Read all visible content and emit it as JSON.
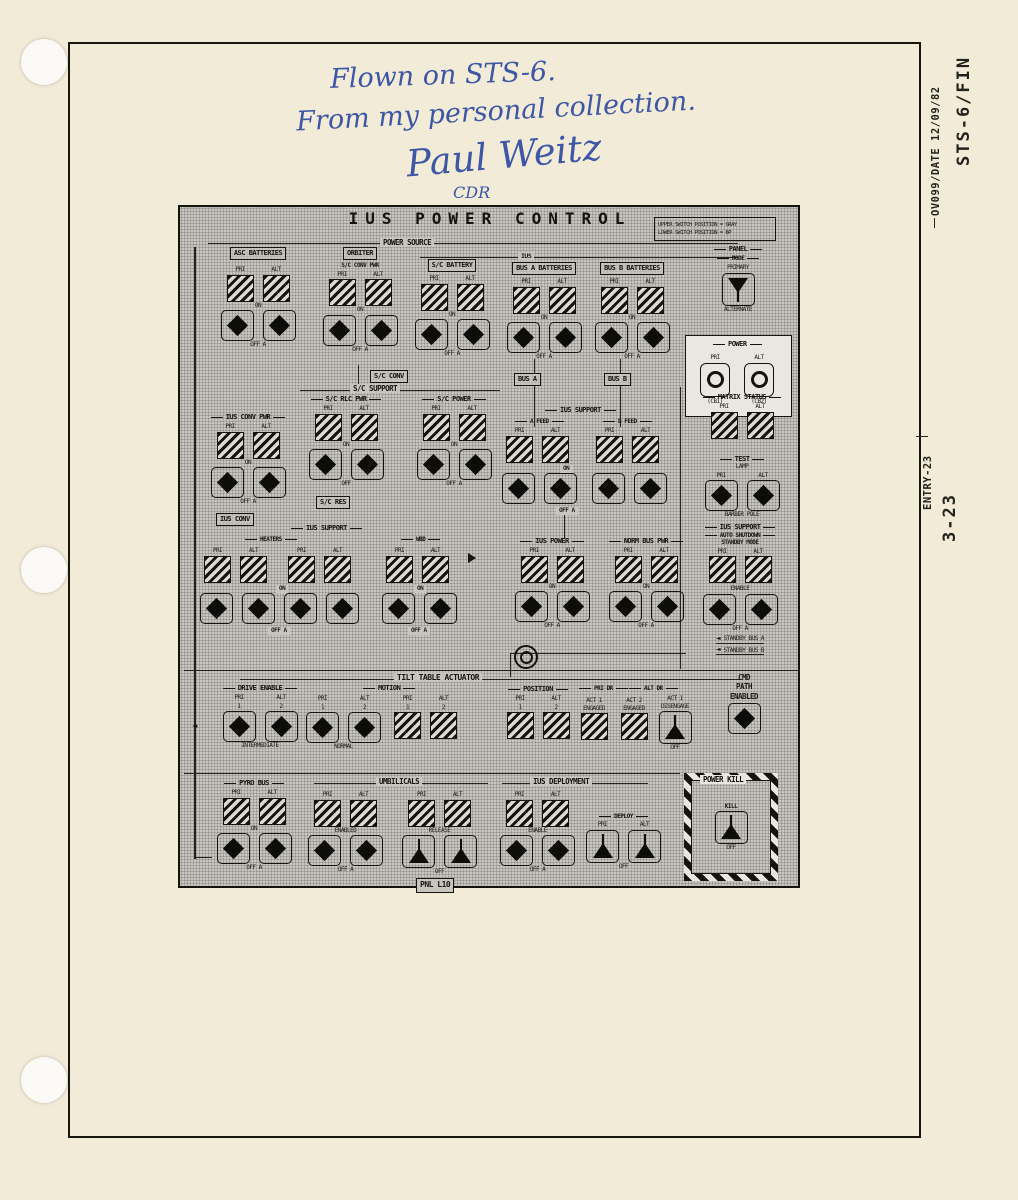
{
  "margin": {
    "doc_ref": "OV099/DATE 12/09/82",
    "mission": "STS-6/FIN",
    "entry": "ENTRY-23",
    "page_num": "3-23"
  },
  "handwriting": {
    "line1": "Flown on STS-6.",
    "line2": "From my personal collection.",
    "signature": "Paul Weitz",
    "role": "CDR",
    "ink_color": "#3d56a5"
  },
  "diagram": {
    "title": "IUS POWER CONTROL",
    "note1": "UPPER SWITCH POSITION = GRAY",
    "note2": "LOWER SWITCH POSITION = BP",
    "footer": "PNL L10",
    "halftone_base": "#c8c5bf"
  },
  "sec": {
    "power_source": "POWER SOURCE",
    "asc_batteries": "ASC BATTERIES",
    "orbiter": "ORBITER",
    "sc_conv_pwr": "S/C CONV PWR",
    "sc_conv": "S/C CONV",
    "ius": "IUS",
    "sc_battery": "S/C BATTERY",
    "bus_a_batteries": "BUS A BATTERIES",
    "bus_b_batteries": "BUS B BATTERIES",
    "bus_a": "BUS A",
    "bus_b": "BUS B",
    "panel": "PANEL",
    "mode": "MODE",
    "primary": "PRIMARY",
    "alternate": "ALTERNATE",
    "power": "POWER",
    "cb1": "(CB1)",
    "cb2": "(CB2)",
    "matrix_status": "MATRIX STATUS",
    "test": "TEST",
    "lamp": "LAMP",
    "barber_pole": "BARBER POLE",
    "ius_support": "IUS SUPPORT",
    "auto_shutdown": "AUTO SHUTDOWN",
    "standby_mode": "STANDBY MODE",
    "enable": "ENABLE",
    "standby_bus_a": "STANDBY BUS A",
    "standby_bus_b": "STANDBY BUS B",
    "ius_conv_pwr": "IUS CONV PWR",
    "ius_conv": "IUS CONV",
    "sc_support": "S/C SUPPORT",
    "sc_rlc_pwr": "S/C RLC PWR",
    "sc_res": "S/C RES",
    "sc_power": "S/C POWER",
    "a_feed": "A FEED",
    "b_feed": "B FEED",
    "heaters": "HEATERS",
    "wbd": "WBD",
    "ius_power": "IUS POWER",
    "norm_bus_pwr": "NORM BUS PWR",
    "tilt_table": "TILT TABLE ACTUATOR",
    "drive_enable": "DRIVE ENABLE",
    "motion": "MOTION",
    "intermediate": "INTERMEDIATE",
    "normal": "NORMAL",
    "position": "POSITION",
    "pri_dr": "PRI DR",
    "alt_dr": "ALT DR",
    "act1_engaged": "ACT 1 ENGAGED",
    "act2_engaged": "ACT 2 ENGAGED",
    "act1_disengage": "ACT 1 DISENGAGE",
    "cmd": "CMD",
    "path": "PATH",
    "enabled": "ENABLED",
    "pyro_bus": "PYRO BUS",
    "umbilicals": "UMBILICALS",
    "release": "RELEASE",
    "ius_deployment": "IUS DEPLOYMENT",
    "deploy": "DEPLOY",
    "power_kill": "POWER KILL",
    "kill": "KILL"
  },
  "lbl": {
    "pri": "PRI",
    "alt": "ALT",
    "on": "ON",
    "off": "OFF",
    "off_a": "OFF A",
    "one": "1",
    "two": "2"
  }
}
